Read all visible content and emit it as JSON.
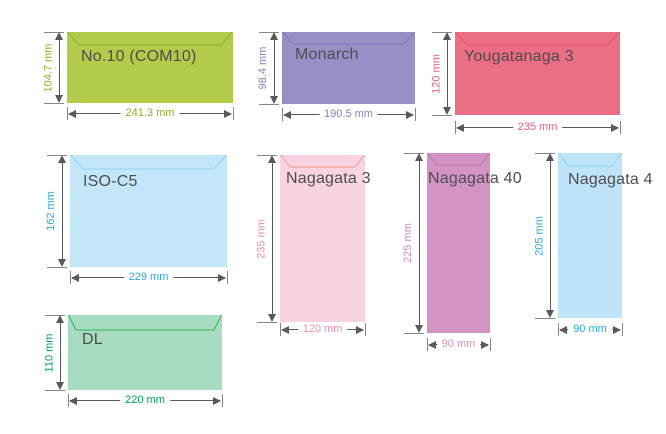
{
  "colors": {
    "background": "#ffffff",
    "arrow": "#58595b",
    "tick": "#85878a",
    "name_text": "#4d4d4d"
  },
  "envelopes": [
    {
      "id": "no10",
      "name": "No.10 (COM10)",
      "width_label": "241.3 mm",
      "height_label": "104.7 mm",
      "width_mm": 241.3,
      "height_mm": 104.7,
      "fill": "#b2cb49",
      "flap_stroke": "#93aa31",
      "dim_color": "#8ab31e",
      "layout": {
        "x": 67,
        "y": 32,
        "w": 166,
        "h": 71,
        "flap_depth": 13,
        "flap_inset": 12,
        "hdim_dy": 10,
        "name_dx": 14,
        "name_dy": 16
      }
    },
    {
      "id": "monarch",
      "name": "Monarch",
      "width_label": "190.5 mm",
      "height_label": "98.4 mm",
      "width_mm": 190.5,
      "height_mm": 98.4,
      "fill": "#9790c6",
      "flap_stroke": "#8279b9",
      "dim_color": "#8c7ec3",
      "layout": {
        "x": 282,
        "y": 32,
        "w": 133,
        "h": 72,
        "flap_depth": 12,
        "flap_inset": 11,
        "hdim_dy": 10,
        "name_dx": 13,
        "name_dy": 14
      }
    },
    {
      "id": "yougatanaga3",
      "name": "Yougatanaga 3",
      "width_label": "235 mm",
      "height_label": "120 mm",
      "width_mm": 235,
      "height_mm": 120,
      "fill": "#ec6e85",
      "flap_stroke": "#e35672",
      "dim_color": "#ef5d7d",
      "layout": {
        "x": 455,
        "y": 32,
        "w": 165,
        "h": 83,
        "flap_depth": 13,
        "flap_inset": 12,
        "hdim_dy": 12,
        "name_dx": 9,
        "name_dy": 16
      }
    },
    {
      "id": "isoc5",
      "name": "ISO-C5",
      "width_label": "229 mm",
      "height_label": "162 mm",
      "width_mm": 229,
      "height_mm": 162,
      "fill": "#c4e6fa",
      "flap_stroke": "#90d1f3",
      "dim_color": "#29abe2",
      "layout": {
        "x": 70,
        "y": 155,
        "w": 157,
        "h": 112,
        "flap_depth": 14,
        "flap_inset": 13,
        "hdim_dy": 10,
        "name_dx": 13,
        "name_dy": 18
      }
    },
    {
      "id": "nagagata3",
      "name": "Nagagata 3",
      "width_label": "120 mm",
      "height_label": "235 mm",
      "width_mm": 120,
      "height_mm": 235,
      "fill": "#f8d3e1",
      "flap_stroke": "#f09a80",
      "dim_color": "#f18cab",
      "layout": {
        "x": 280,
        "y": 155,
        "w": 85,
        "h": 167,
        "flap_depth": 12,
        "flap_inset": 10,
        "hdim_dy": 7,
        "name_dx": 6,
        "name_dy": 15
      }
    },
    {
      "id": "nagagata40",
      "name": "Nagagata 40",
      "width_label": "90 mm",
      "height_label": "225 mm",
      "width_mm": 90,
      "height_mm": 225,
      "fill": "#d394c5",
      "flap_stroke": "#c173ac",
      "dim_color": "#cc90c1",
      "layout": {
        "x": 427,
        "y": 153,
        "w": 63,
        "h": 180,
        "flap_depth": 12,
        "flap_inset": 9,
        "hdim_dy": 11,
        "name_dx": 1,
        "name_dy": 17
      }
    },
    {
      "id": "nagagata4",
      "name": "Nagagata 4",
      "width_label": "90 mm",
      "height_label": "205 mm",
      "width_mm": 90,
      "height_mm": 205,
      "fill": "#bfe4fa",
      "flap_stroke": "#8ed2f4",
      "dim_color": "#29abe2",
      "layout": {
        "x": 558,
        "y": 153,
        "w": 64,
        "h": 165,
        "flap_depth": 13,
        "flap_inset": 10,
        "hdim_dy": 11,
        "name_dx": 10,
        "name_dy": 18
      }
    },
    {
      "id": "dl",
      "name": "DL",
      "width_label": "220 mm",
      "height_label": "110 mm",
      "width_mm": 220,
      "height_mm": 110,
      "fill": "#a8dcc2",
      "flap_stroke": "#2fb350",
      "dim_color": "#00a05c",
      "layout": {
        "x": 68,
        "y": 315,
        "w": 154,
        "h": 75,
        "flap_depth": 15,
        "flap_inset": 8,
        "hdim_dy": 10,
        "name_dx": 14,
        "name_dy": 16
      }
    }
  ]
}
